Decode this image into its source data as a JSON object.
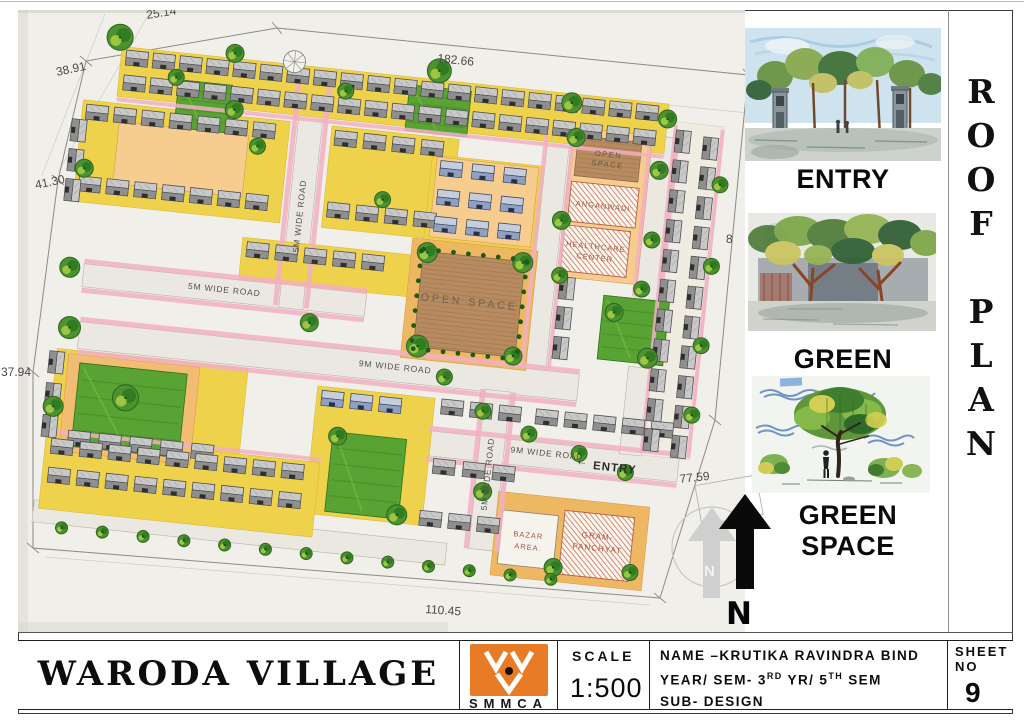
{
  "plan": {
    "dimensions": {
      "top_left": "25.14",
      "top": "182.66",
      "left_upper": "38.91",
      "left_middle": "41.30",
      "left_lower": "37.94",
      "bottom": "110.45",
      "right_lower": "77.59",
      "right_upper": "8"
    },
    "labels": {
      "open_space_small_1": "OPEN",
      "open_space_small_2": "SPACE",
      "anganwadi": "ANGANWADI",
      "healthcare_1": "HEALTHCARE",
      "healthcare_2": "CENTER",
      "open_space_main": "OPEN SPACE",
      "road_5m_left": "5M WIDE ROAD",
      "road_5m_vert_top": "5M WIDE ROAD",
      "road_5m_vert_bottom": "5M WIDE ROAD",
      "road_9m_center": "9M WIDE ROAD",
      "road_9m_bottom": "9M WIDE ROAD",
      "entry_arrow": "←",
      "entry": "ENTRY",
      "bazar_1": "BAZAR",
      "bazar_2": "AREA.",
      "gram_1": "GRAM-",
      "gram_2": "PANCHYAT",
      "north": "N"
    }
  },
  "side_panel": {
    "sketches": [
      {
        "label": "ENTRY"
      },
      {
        "label": "GREEN SPACE"
      },
      {
        "label": "GREEN SPACE"
      }
    ]
  },
  "vertical_title": {
    "text": "R\nO\nO\nF\n\nP\nL\nA\nN"
  },
  "title_block": {
    "project": "WARODA VILLAGE",
    "logo_text": "SMMCA",
    "logo_color": "#e87b26",
    "scale_label": "SCALE",
    "scale_value": "1:500",
    "name_line": "NAME –KRUTIKA RAVINDRA BIND",
    "year_pre": "YEAR/ SEM- 3",
    "year_sup1": "RD",
    "year_mid": " YR/ 5",
    "year_sup2": "TH",
    "year_post": " SEM",
    "sub_line": "SUB- DESIGN",
    "sheet_label_1": "SHEET",
    "sheet_label_2": "NO",
    "sheet_number": "9"
  }
}
